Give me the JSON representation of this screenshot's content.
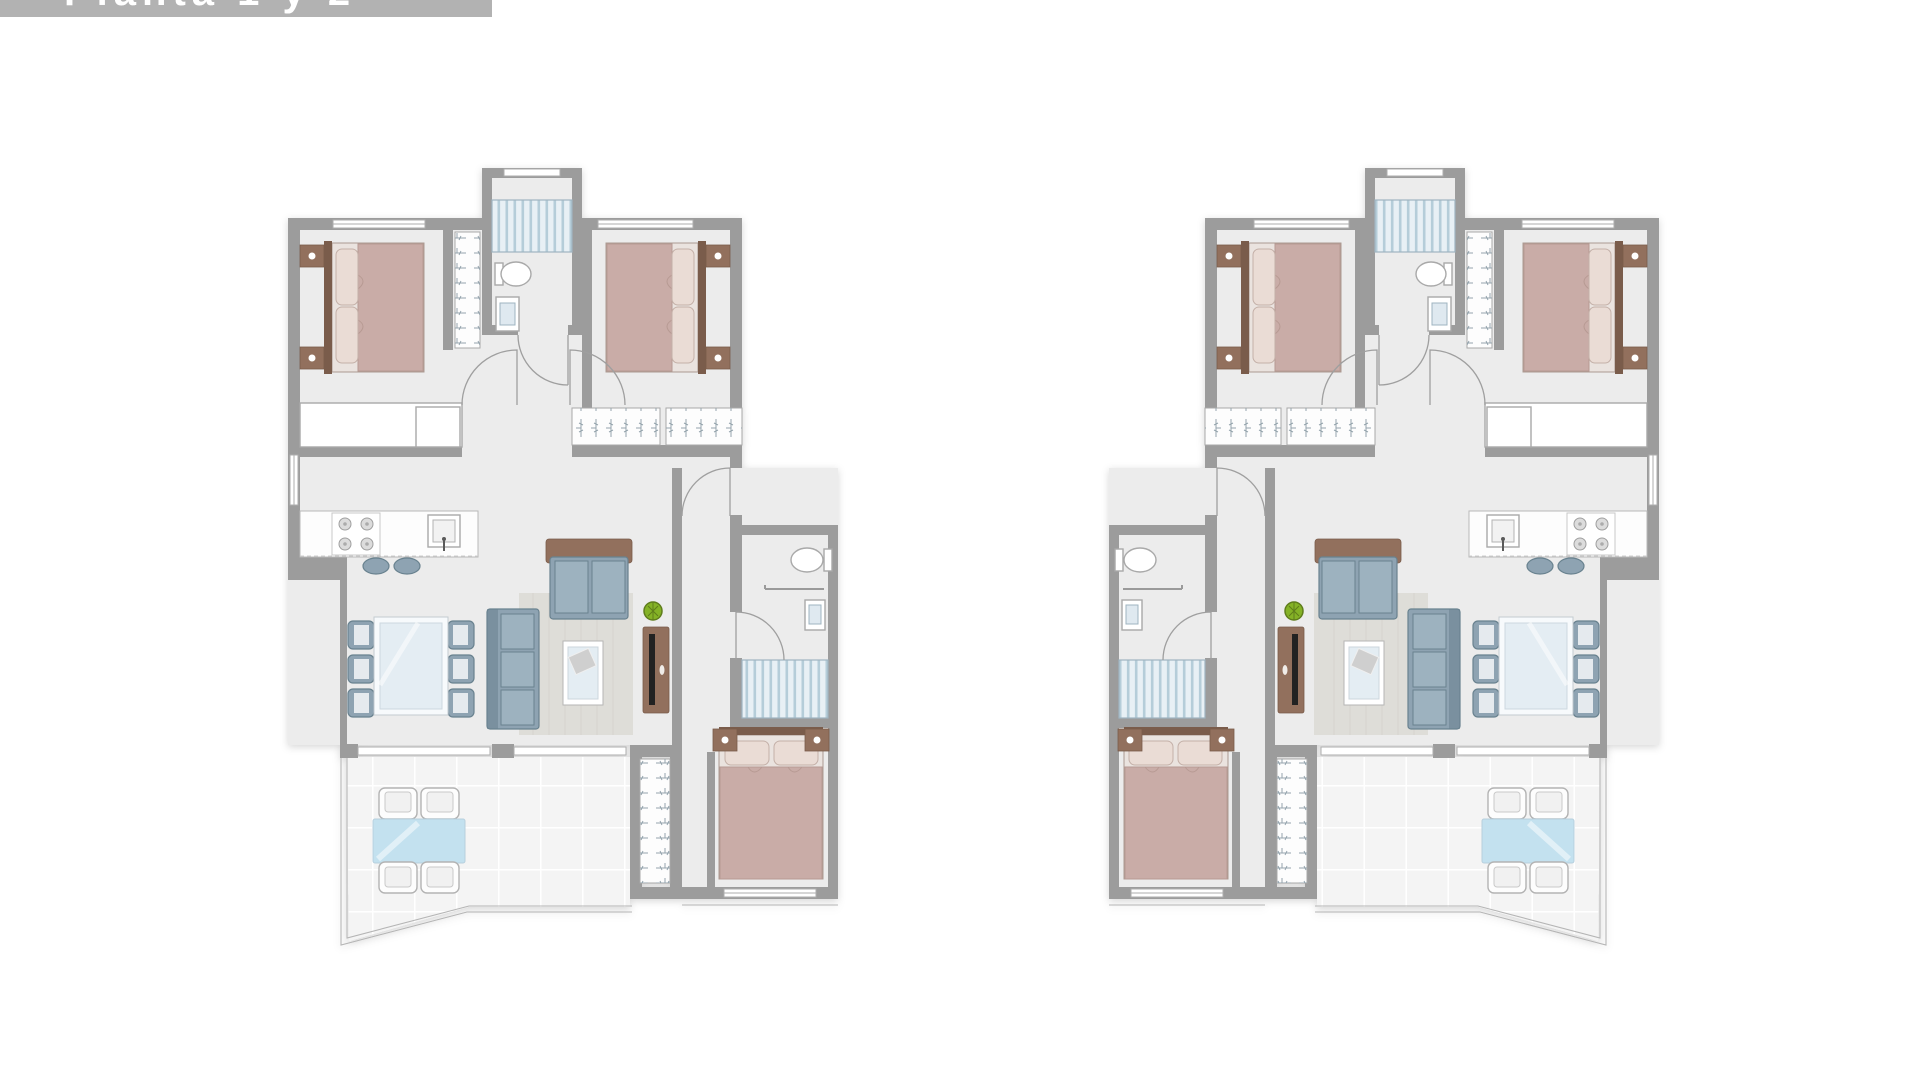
{
  "banner": {
    "title": "Planta 1 y 2"
  },
  "palette": {
    "banner_bg": "#b2b2b2",
    "banner_text": "#ffffff",
    "wall": "#9c9c9c",
    "wall_dark": "#8b8b8b",
    "floor": "#ececec",
    "tile": "#f4f4f4",
    "tile_line": "#ffffff",
    "duvet": "#c9aca7",
    "pillow": "#eadcd5",
    "bed_frame": "#eae3df",
    "wood": "#92705d",
    "wood_dark": "#7a5c4b",
    "sofa": "#8ea3b2",
    "sofa_dark": "#69828f",
    "cushion": "#9db2bf",
    "glass": "#e4edf3",
    "outdoor": "#c3e1ef",
    "stripe_bg": "#e8f0f5",
    "stripe": "#b5cdd9",
    "plant": "#84b226",
    "plant_dark": "#5f7d1d",
    "rug": "#dcdbd5",
    "door": "#9f9f9f",
    "white": "#ffffff"
  },
  "plans": [
    {
      "id": "plan-left",
      "label": "apartment floor plan left",
      "mirrored": false
    },
    {
      "id": "plan-right",
      "label": "apartment floor plan right",
      "mirrored": true
    }
  ],
  "unit": {
    "rooms": [
      {
        "name": "bedroom-1",
        "furniture": [
          "double-bed",
          "2-nightstands",
          "long-dresser",
          "wardrobe"
        ]
      },
      {
        "name": "bedroom-2",
        "furniture": [
          "double-bed",
          "2-nightstands",
          "wardrobe-2-sections"
        ]
      },
      {
        "name": "bedroom-3",
        "furniture": [
          "double-bed",
          "2-nightstands",
          "wardrobe"
        ]
      },
      {
        "name": "bathroom-1",
        "furniture": [
          "shower",
          "toilet",
          "washbasin"
        ]
      },
      {
        "name": "bathroom-2",
        "furniture": [
          "shower",
          "toilet",
          "washbasin-counter"
        ]
      },
      {
        "name": "kitchen",
        "furniture": [
          "cooktop-4-burners",
          "sink",
          "island-counter",
          "2-stools"
        ]
      },
      {
        "name": "living-dining",
        "furniture": [
          "dining-table",
          "6-chairs",
          "sofa-2-seat",
          "sofa-3-seat",
          "coffee-table",
          "tv-sideboard",
          "rug",
          "plant"
        ]
      },
      {
        "name": "terrace",
        "furniture": [
          "outdoor-table",
          "4-outdoor-chairs"
        ]
      },
      {
        "name": "hall",
        "furniture": []
      }
    ]
  }
}
